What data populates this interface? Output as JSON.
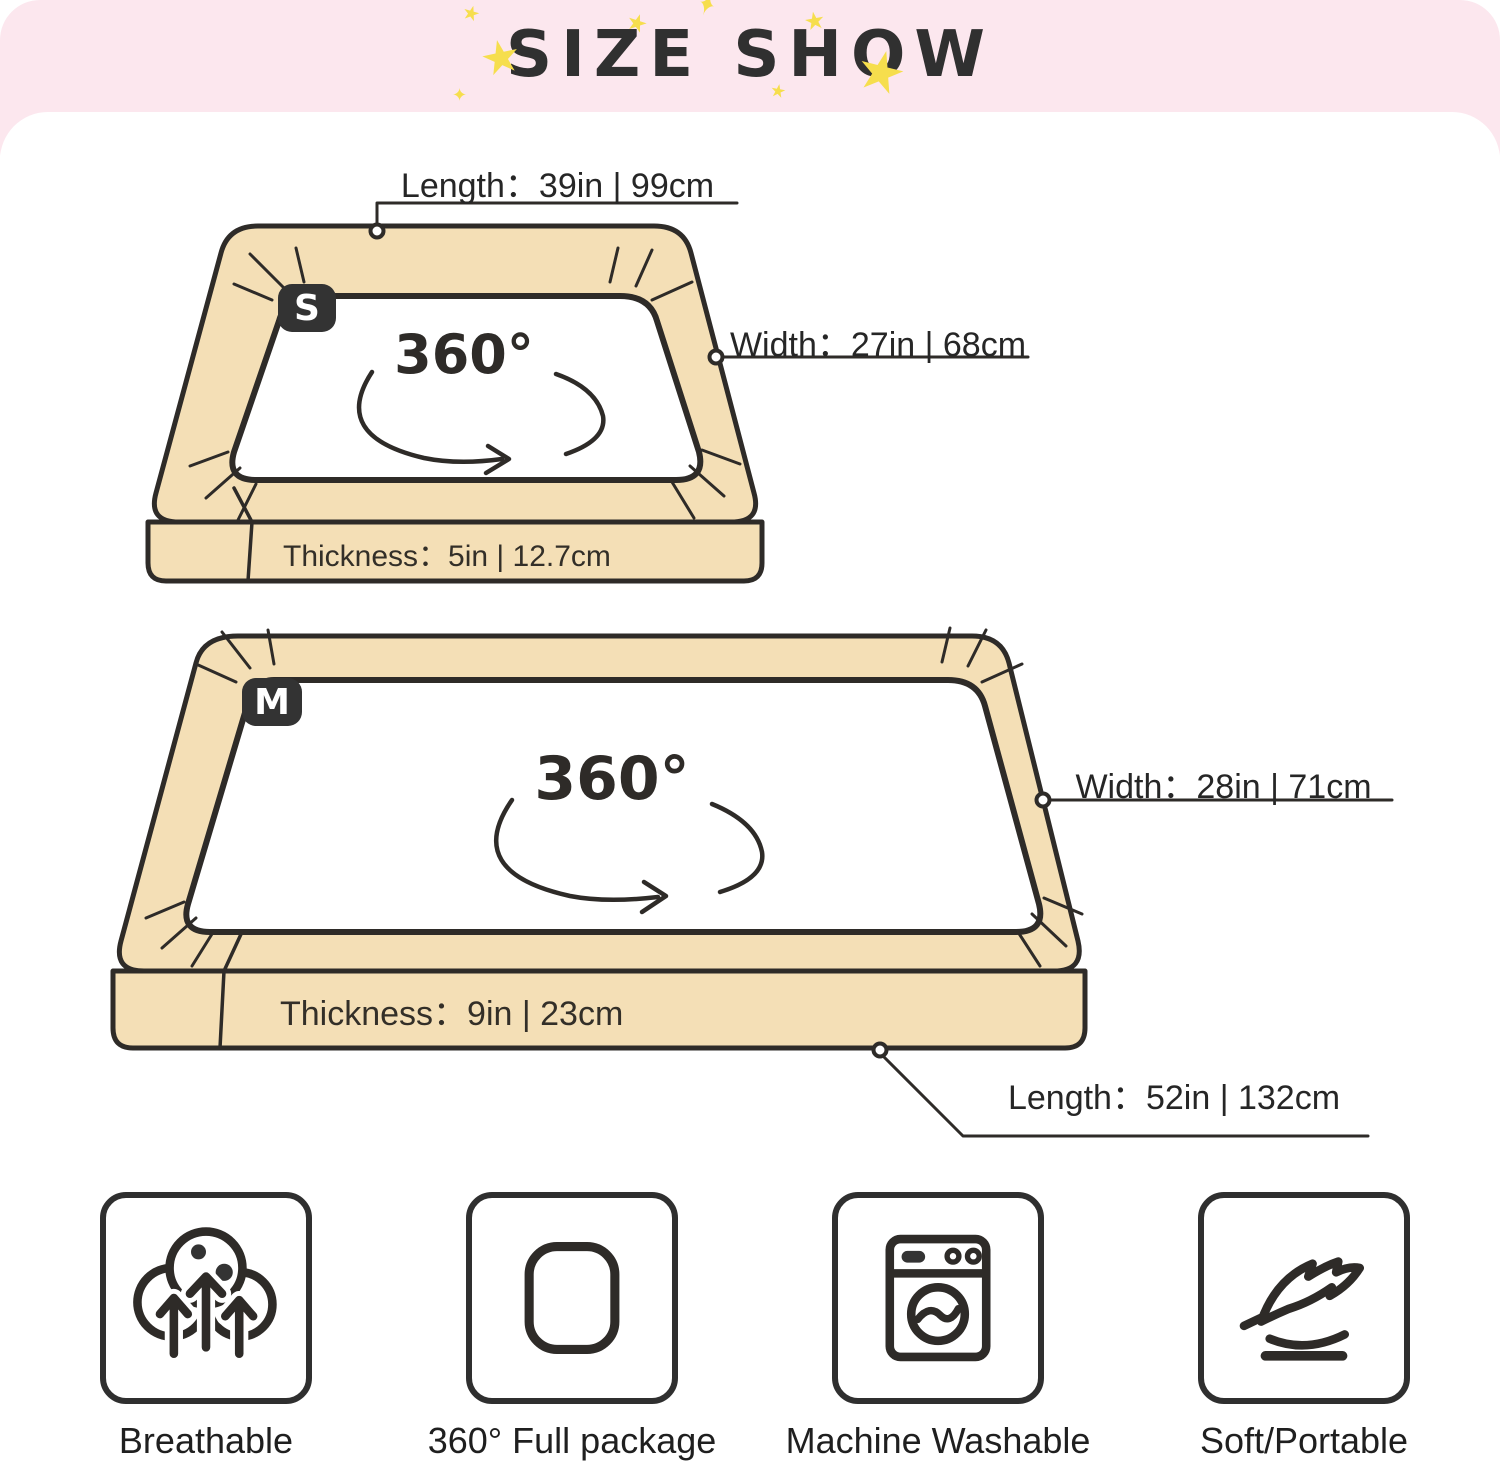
{
  "banner": {
    "title": "SIZE SHOW"
  },
  "beds": {
    "small": {
      "badge": "S",
      "rotation": "360°",
      "length_label": "Length：39in | 99cm",
      "width_label": "Width：27in | 68cm",
      "thickness_label": "Thickness：5in | 12.7cm"
    },
    "medium": {
      "badge": "M",
      "rotation": "360°",
      "length_label": "Length：52in | 132cm",
      "width_label": "Width：28in | 71cm",
      "thickness_label": "Thickness：9in | 23cm"
    }
  },
  "features": [
    {
      "icon": "breathable-icon",
      "label": "Breathable"
    },
    {
      "icon": "full-package-icon",
      "label": "360° Full package"
    },
    {
      "icon": "machine-washable-icon",
      "label": "Machine Washable"
    },
    {
      "icon": "soft-portable-icon",
      "label": "Soft/Portable"
    }
  ],
  "colors": {
    "banner_pink": "#fce7ee",
    "star_yellow": "#f6de4d",
    "bed_beige": "#f4dfb6",
    "outline_ink": "#2e2b28",
    "text_dark": "#1f1f1f"
  }
}
